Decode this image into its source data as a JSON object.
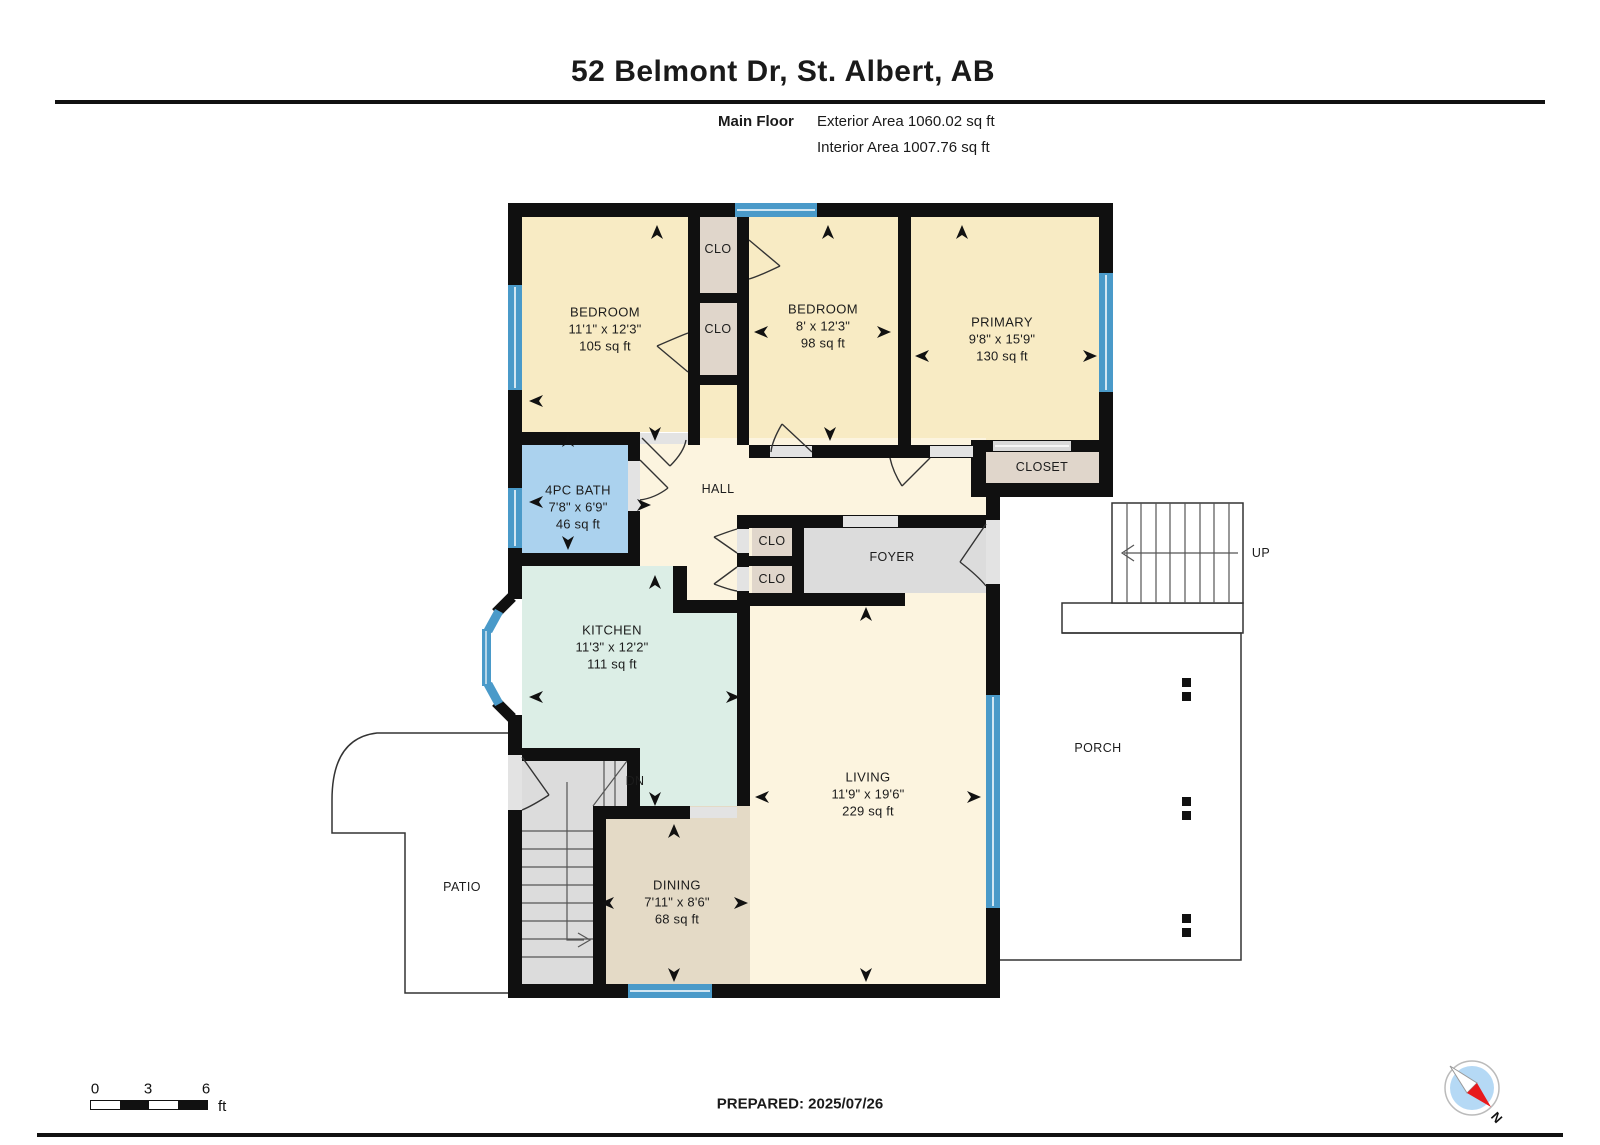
{
  "header": {
    "title": "52 Belmont Dr, St. Albert, AB",
    "floor_label": "Main Floor",
    "exterior_area": "Exterior Area 1060.02 sq ft",
    "interior_area": "Interior Area 1007.76 sq ft"
  },
  "rooms": {
    "bedroom1": {
      "name": "BEDROOM",
      "dims": "11'1\" x 12'3\"",
      "area": "105 sq ft"
    },
    "bedroom2": {
      "name": "BEDROOM",
      "dims": "8' x 12'3\"",
      "area": "98 sq ft"
    },
    "primary": {
      "name": "PRIMARY",
      "dims": "9'8\" x 15'9\"",
      "area": "130 sq ft"
    },
    "bath": {
      "name": "4PC BATH",
      "dims": "7'8\" x 6'9\"",
      "area": "46 sq ft"
    },
    "kitchen": {
      "name": "KITCHEN",
      "dims": "11'3\" x 12'2\"",
      "area": "111 sq ft"
    },
    "living": {
      "name": "LIVING",
      "dims": "11'9\" x 19'6\"",
      "area": "229 sq ft"
    },
    "dining": {
      "name": "DINING",
      "dims": "7'11\" x 8'6\"",
      "area": "68 sq ft"
    },
    "hall": {
      "name": "HALL"
    },
    "foyer": {
      "name": "FOYER"
    },
    "primary_closet": {
      "name": "CLOSET"
    },
    "closet_small": {
      "name": "CLO"
    },
    "porch": {
      "name": "PORCH"
    },
    "patio": {
      "name": "PATIO"
    }
  },
  "stairs": {
    "up": "UP",
    "down": "DN"
  },
  "footer": {
    "prepared_label": "PREPARED: 2025/07/26",
    "scale_ticks": [
      "0",
      "3",
      "6"
    ],
    "scale_unit": "ft",
    "compass_north": "N"
  },
  "colors": {
    "wall": "#101010",
    "window": "#4a9ac9",
    "bedroom_fill": "#f8ebc4",
    "hall_fill": "#fcf4df",
    "bath_fill": "#abd2ee",
    "kitchen_fill": "#dceee6",
    "dining_fill": "#e4dac6",
    "closet_fill": "#e0d6cb",
    "gray_fill": "#dcdcdc",
    "compass_blue": "#b5d9f5",
    "compass_red": "#e8191c"
  }
}
